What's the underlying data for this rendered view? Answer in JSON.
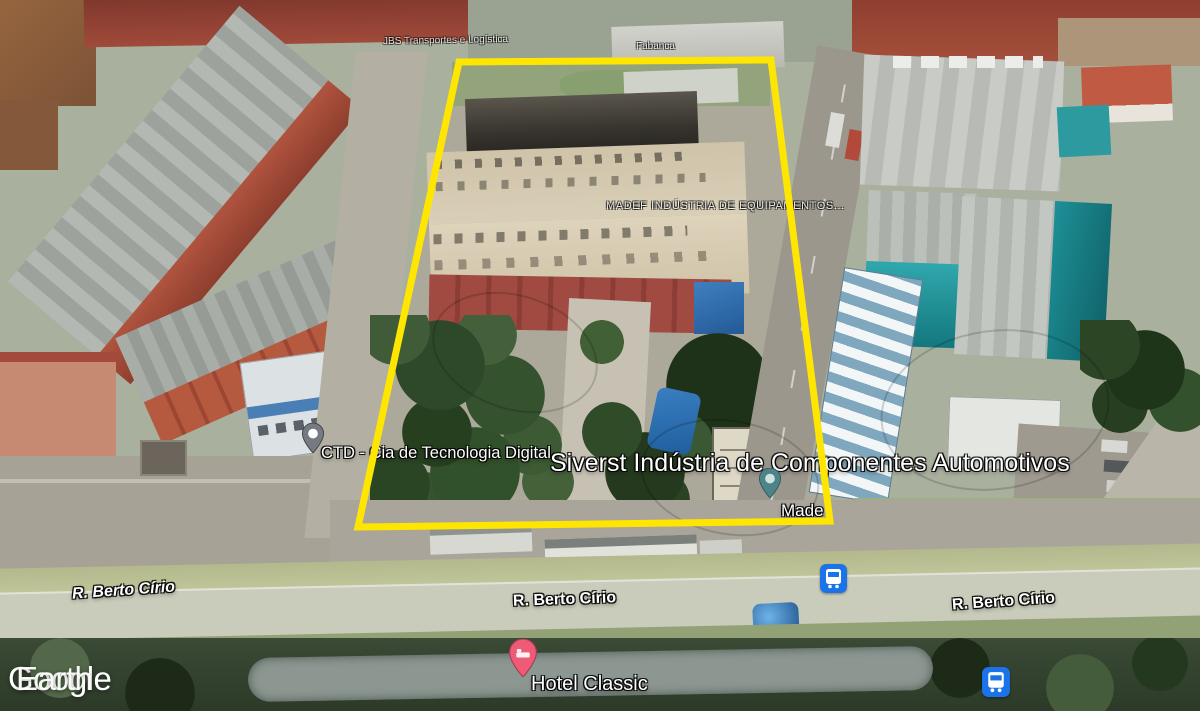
{
  "app": {
    "name": "Google Earth 3D aerial view"
  },
  "logo": {
    "google": "Google",
    "earth": "Earth"
  },
  "overlay": {
    "polygon_points": "459,62 771,60 830,521 358,527",
    "outline_color": "#FFE600"
  },
  "labels": {
    "business_top_left": "JBS Transportes e Logística",
    "business_top_right": "Fabanca",
    "madef": "MADEF INDÚSTRIA DE EQUIPAMENTOS...",
    "ctd": "CTD - Cia de Tecnologia Digital",
    "siverst": "Siverst Indústria de Componentes Automotivos",
    "made_partial": "Made",
    "street_left": "R. Berto Círio",
    "street_center": "R. Berto Círio",
    "street_right": "R. Berto Círio",
    "hotel": "Hotel Classic"
  },
  "markers": {
    "ctd_pin_color": "#757B80",
    "made_pin_color": "#4E838A",
    "hotel_pin_color": "#EE5B76"
  },
  "icons": {
    "transit_color": "#1A73E8"
  }
}
